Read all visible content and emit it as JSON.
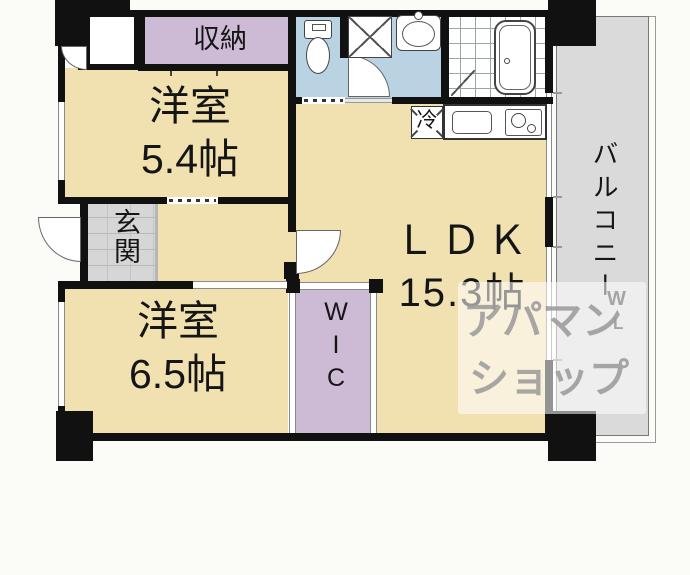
{
  "type": "floor_plan",
  "rooms": {
    "storage": {
      "name": "収納"
    },
    "bedroom_small": {
      "name": "洋室",
      "area": "5.4帖"
    },
    "entrance": {
      "name": "玄関"
    },
    "bedroom_large": {
      "name": "洋室",
      "area": "6.5帖"
    },
    "wic": {
      "name": "WIC"
    },
    "ldk": {
      "name": "ＬＤＫ",
      "area": "15.3帖"
    },
    "balcony": {
      "name": "バルコニー"
    }
  },
  "kitchen": {
    "refrigerator_label": "冷"
  },
  "watermark": {
    "line1": "アパマン",
    "line2": "ショップ",
    "mark_top": "W",
    "mark_bottom": "L"
  },
  "colors": {
    "room_fill": "#f1e1b0",
    "closet_fill": "#cdbad5",
    "sanitary_fill": "#b9d3e3",
    "entrance_fill": "#d6d6d6",
    "balcony_fill": "#dadada",
    "wall": "#111111",
    "watermark_text": "#999999",
    "background": "#fbfbf8"
  }
}
